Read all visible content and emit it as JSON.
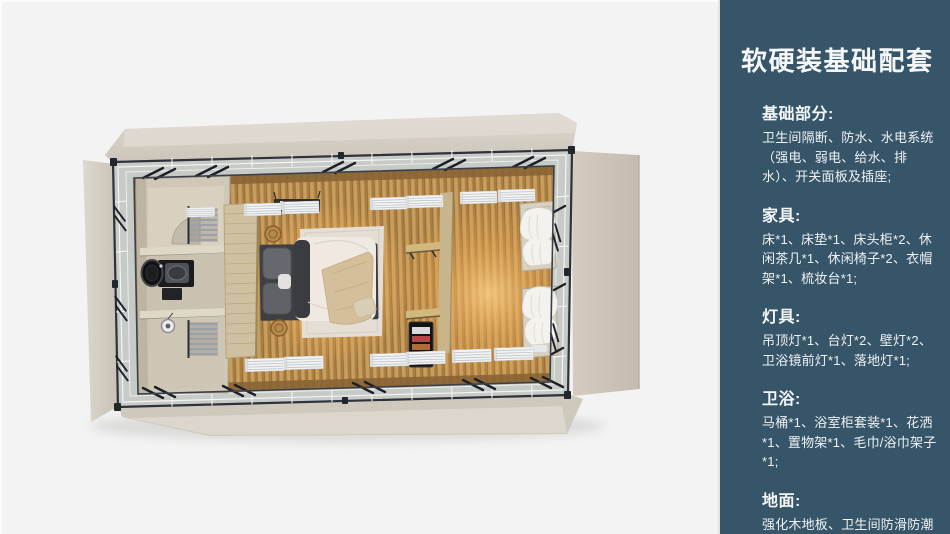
{
  "panel": {
    "title": "软硬装基础配套",
    "sections": [
      {
        "id": "basics",
        "heading": "基础部分:",
        "body": "卫生间隔断、防水、水电系统（强电、弱电、给水、排水）、开关面板及插座;"
      },
      {
        "id": "furniture",
        "heading": "家具:",
        "body": "床*1、床垫*1、床头柜*2、休闲茶几*1、休闲椅子*2、衣帽架*1、梳妆台*1;"
      },
      {
        "id": "lighting",
        "heading": "灯具:",
        "body": "吊顶灯*1、台灯*2、壁灯*2、卫浴镜前灯*1、落地灯*1;"
      },
      {
        "id": "bathroom",
        "heading": "卫浴:",
        "body": "马桶*1、浴室柜套装*1、花洒*1、置物架*1、毛巾/浴巾架子*1;"
      },
      {
        "id": "flooring",
        "heading": "地面:",
        "body": "强化木地板、卫生间防滑防潮石塑板;"
      }
    ],
    "colors": {
      "sidebar_background": "#375569",
      "sidebar_text": "#f4f6f7",
      "canvas_background": "#f2f3f2",
      "wall_beige": "#d5cec4",
      "floor_wood": "#c39a5c",
      "warm_glow": "#ffc070"
    }
  }
}
